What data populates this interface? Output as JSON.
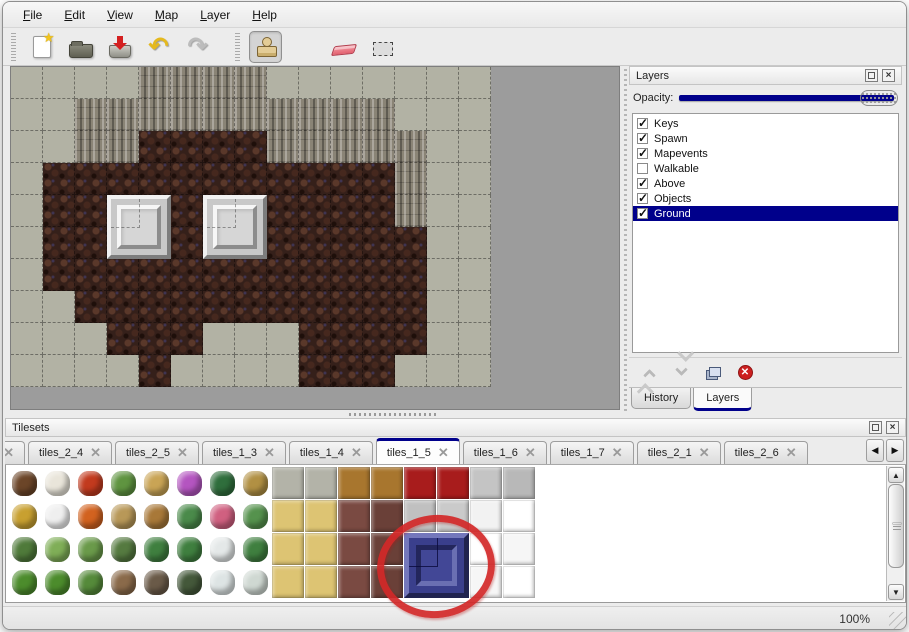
{
  "colors": {
    "accent_navy": "#00008b",
    "annotation_red": "#d42828",
    "canvas_gray": "#9c9c9c",
    "rock_gray": "#b2b2a4",
    "cliff_gray": "#8a8476",
    "floor_brown": "#35201a",
    "block_silver": "#c8c8c8",
    "blue_tile": "#3a3f8c"
  },
  "menu": {
    "items": [
      "File",
      "Edit",
      "View",
      "Map",
      "Layer",
      "Help"
    ]
  },
  "toolbar": {
    "buttons": [
      {
        "name": "new",
        "icon": "new-file-icon",
        "selected": false
      },
      {
        "name": "open",
        "icon": "open-folder-icon",
        "selected": false
      },
      {
        "name": "save",
        "icon": "save-icon",
        "selected": false
      },
      {
        "name": "undo",
        "icon": "undo-icon",
        "selected": false,
        "glyph": "↶"
      },
      {
        "name": "redo",
        "icon": "redo-icon",
        "selected": false,
        "glyph": "↷"
      },
      {
        "name": "stamp",
        "icon": "stamp-tool-icon",
        "selected": true,
        "group": 2
      },
      {
        "name": "fill",
        "icon": "paint-bucket-icon",
        "selected": false,
        "group": 2
      },
      {
        "name": "eraser",
        "icon": "eraser-icon",
        "selected": false,
        "group": 2
      },
      {
        "name": "select",
        "icon": "selection-rect-icon",
        "selected": false,
        "group": 2
      }
    ]
  },
  "map": {
    "tile_size": 32,
    "legend": {
      "S": "scale-rock",
      "C": "cliff-wall",
      "F": "brown-floor"
    },
    "rows": [
      "SSSSCCCCSSSSSSS",
      "SSCCCCCCCCCCSSS",
      "SSCCFFFFCCCCCSS",
      "SFFFFFFFFFFFCSS",
      "SFFFFFFFFFFFCSS",
      "SFFFFFFFFFFFFSS",
      "SFFFFFFFFFFFFSS",
      "SSFFFFFFFFFFFSS",
      "SSSFFFSSSFFFFSS",
      "SSSSFSSSSFFFSSS"
    ],
    "blocks": [
      {
        "col": 3,
        "row": 4
      },
      {
        "col": 6,
        "row": 4
      }
    ]
  },
  "layers_panel": {
    "title": "Layers",
    "opacity_label": "Opacity:",
    "opacity_percent": 100,
    "layers": [
      {
        "name": "Keys",
        "checked": true,
        "selected": false
      },
      {
        "name": "Spawn",
        "checked": true,
        "selected": false
      },
      {
        "name": "Mapevents",
        "checked": true,
        "selected": false
      },
      {
        "name": "Walkable",
        "checked": false,
        "selected": false
      },
      {
        "name": "Above",
        "checked": true,
        "selected": false
      },
      {
        "name": "Objects",
        "checked": true,
        "selected": false
      },
      {
        "name": "Ground",
        "checked": true,
        "selected": true
      }
    ],
    "action_icons": [
      "move-layer-up-icon",
      "move-layer-down-icon",
      "duplicate-layer-icon",
      "delete-layer-icon"
    ],
    "bottom_tabs": [
      {
        "label": "History",
        "active": false
      },
      {
        "label": "Layers",
        "active": true
      }
    ]
  },
  "tilesets_panel": {
    "title": "Tilesets",
    "tabs": [
      {
        "label": "3",
        "active": false,
        "cut": true
      },
      {
        "label": "tiles_2_4",
        "active": false
      },
      {
        "label": "tiles_2_5",
        "active": false
      },
      {
        "label": "tiles_1_3",
        "active": false
      },
      {
        "label": "tiles_1_4",
        "active": false
      },
      {
        "label": "tiles_1_5",
        "active": true
      },
      {
        "label": "tiles_1_6",
        "active": false
      },
      {
        "label": "tiles_1_7",
        "active": false
      },
      {
        "label": "tiles_2_1",
        "active": false
      },
      {
        "label": "tiles_2_6",
        "active": false
      }
    ],
    "grid": [
      [
        "s#6b4528",
        "s#e9e5da",
        "s#c23a1e",
        "s#5f9440",
        "s#c9a455",
        "s#b455c0",
        "s#2f6e3c",
        "s#b19043",
        "t#b3b3a8",
        "t#b3b3a8",
        "t#a8762e",
        "t#a8762e",
        "t#a81c1c",
        "t#a81c1c",
        "t#c4c4c4",
        "t#b8b8b8"
      ],
      [
        "s#c8a030",
        "s#efefef",
        "s#d2621f",
        "s#b89858",
        "s#a87838",
        "s#4a8a4a",
        "s#d06080",
        "s#55924d",
        "t#ddc473",
        "t#ddc473",
        "t#7a4a42",
        "t#6a4038",
        "t#c0c0c0",
        "t#cacaca",
        "t#f2f2f2",
        "t#ffffff"
      ],
      [
        "s#4f7a3a",
        "s#7fae57",
        "s#6a9a4a",
        "s#557a40",
        "s#3f7f3f",
        "s#3f7f3f",
        "s#e4e8e8",
        "s#3f7f3f",
        "t#ddc473",
        "t#ddc473",
        "t#7a4a42",
        "t#6a4038",
        "e",
        "e",
        "t#ffffff",
        "t#f6f6f6"
      ],
      [
        "s#4c8c2c",
        "s#4c8c2c",
        "s#558a3a",
        "s#8a6a4a",
        "s#6a5a48",
        "s#44583a",
        "s#dde4e4",
        "s#cfd8d2",
        "t#ddc473",
        "t#ddc473",
        "t#7a4a42",
        "t#6a4038",
        "e",
        "e",
        "t#f6f6f6",
        "t#ffffff"
      ]
    ],
    "blue_block": {
      "col": 12,
      "row": 2,
      "span": 2
    }
  },
  "status_bar": {
    "zoom_level": "100%"
  }
}
